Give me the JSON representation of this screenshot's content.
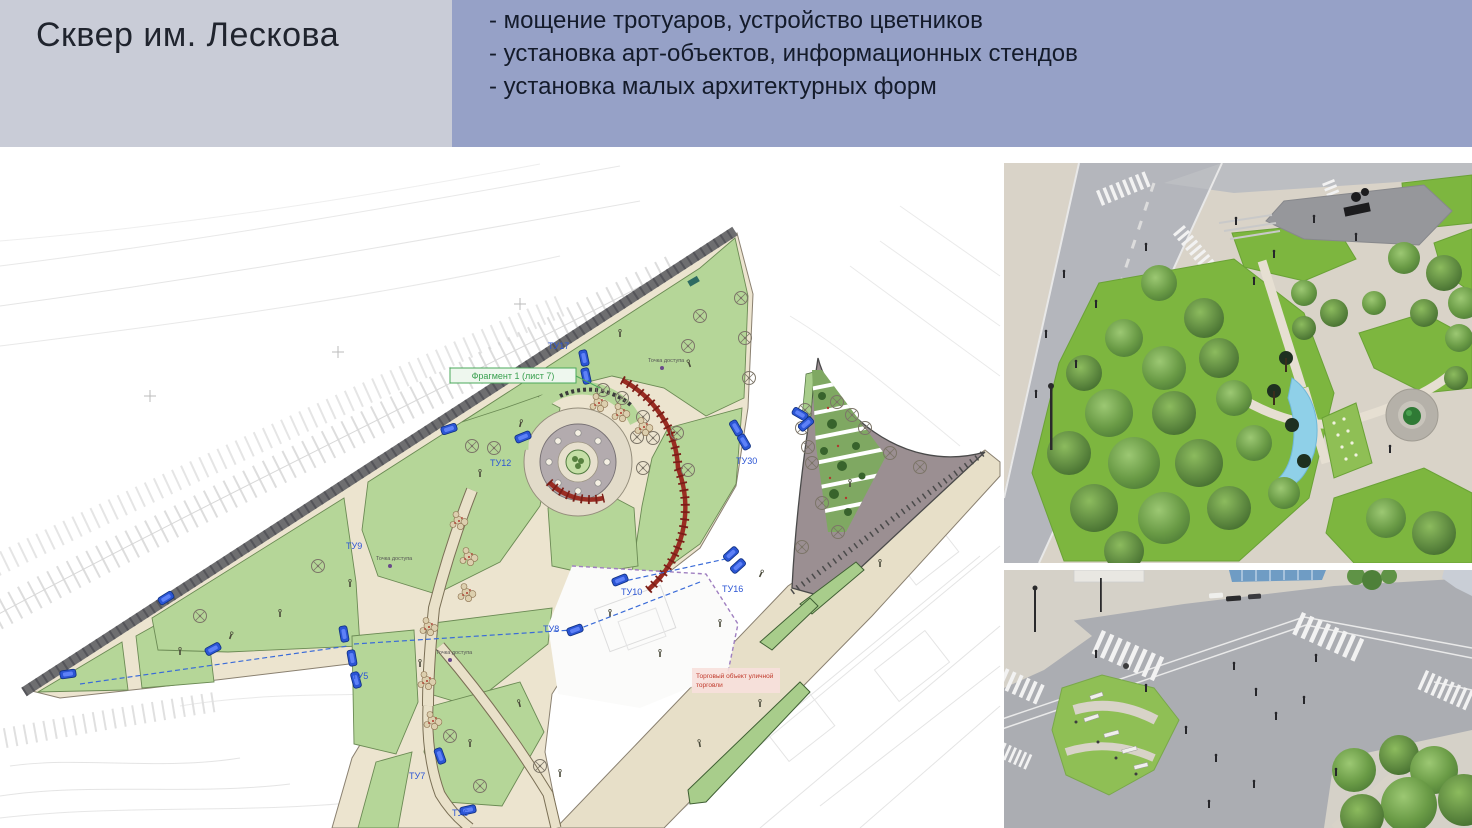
{
  "header": {
    "title": "Сквер им. Лескова",
    "bullets": [
      "- мощение тротуаров, устройство цветников",
      "- установка арт-объектов, информационных стендов",
      "- установка малых архитектурных форм"
    ],
    "colors": {
      "title_bg": "#c9ccd7",
      "bullets_bg": "#96a1c7",
      "text": "#141b2b"
    }
  },
  "plan": {
    "fragment_label": "Фрагмент 1 (лист 7)",
    "access_point_label": "Точка доступа",
    "red_note": {
      "line1": "Торговый объект уличной",
      "line2": "торговли"
    },
    "tu_labels": [
      {
        "text": "ТУ17"
      },
      {
        "text": "ТУ12"
      },
      {
        "text": "ТУ30"
      },
      {
        "text": "ТУ9"
      },
      {
        "text": "ТУ16"
      },
      {
        "text": "ТУ10"
      },
      {
        "text": "ТУ8"
      },
      {
        "text": "ТУ5"
      },
      {
        "text": "ТУ7"
      },
      {
        "text": "ТУ6"
      }
    ],
    "colors": {
      "lawn": "#b5d698",
      "path": "#e9e1c9",
      "boundary_road": "#6e6e70",
      "pergola_red": "#9a2c22",
      "mauve_plaza": "#9b8f92",
      "marker_blue": "#2b55d4",
      "fragment_green": "#3aa050",
      "note_red": "#c0392b",
      "dashed_outline_purple": "#9f7fc0"
    }
  },
  "renders": {
    "grass": "#7db63f",
    "asphalt": "#abadb2",
    "water": "#8fd0e8",
    "pavement": "#d9d3c8"
  }
}
